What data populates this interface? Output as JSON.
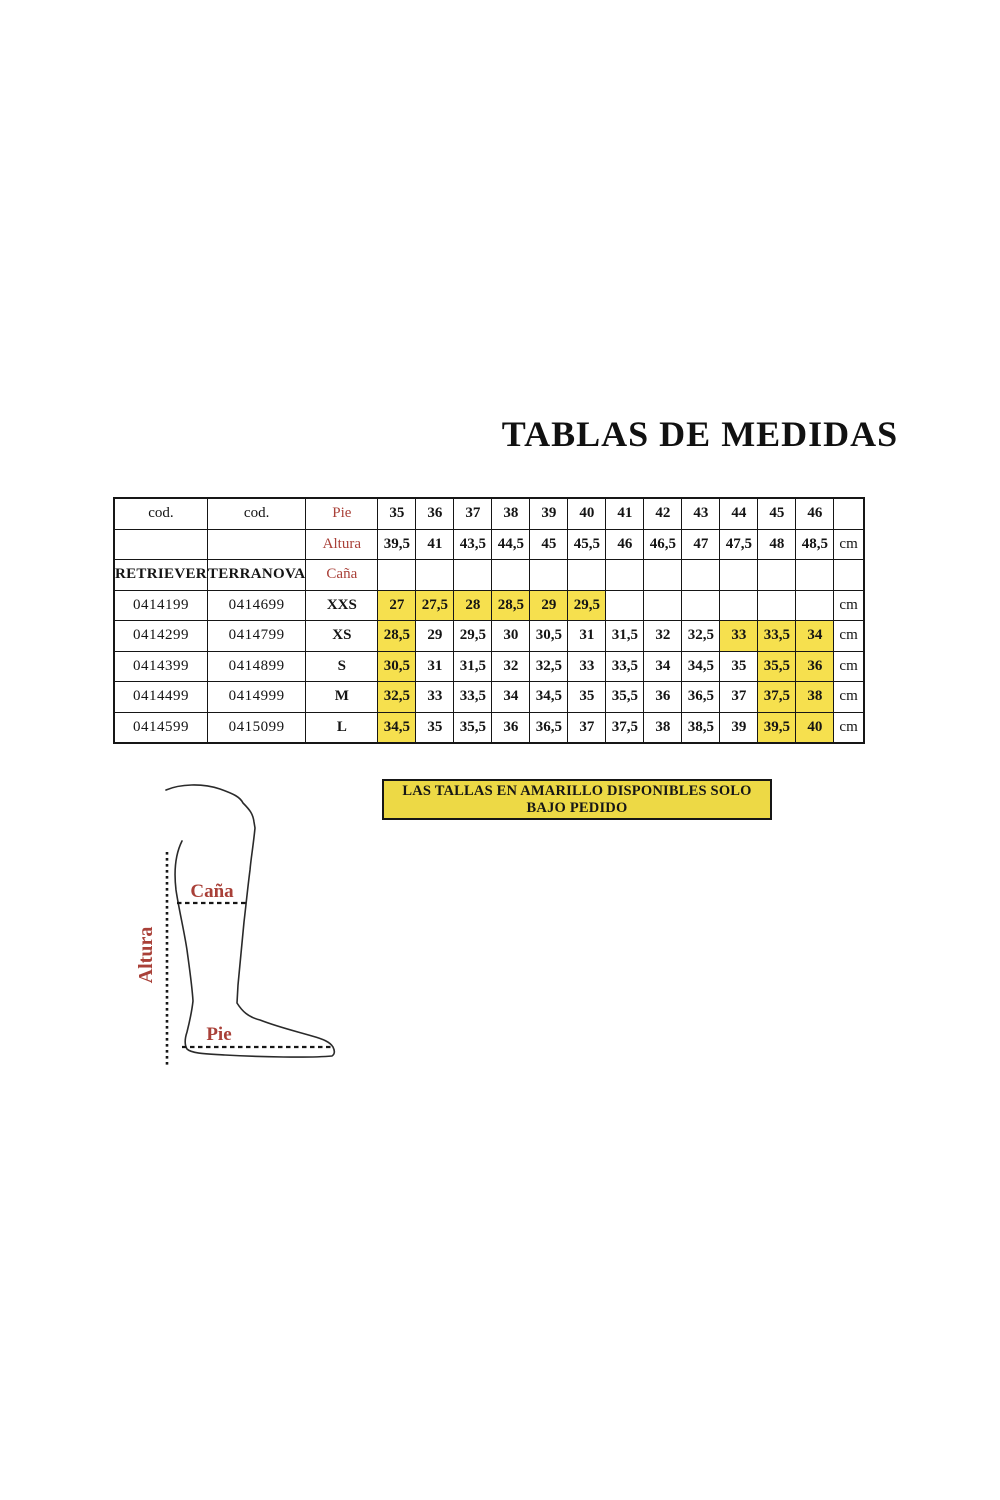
{
  "title": "TABLAS DE MEDIDAS",
  "colors": {
    "cell_highlight": "#F6E04E",
    "note_background": "#EDD945",
    "label_red": "#A94038"
  },
  "table": {
    "cod_header_1": "cod.",
    "cod_header_2": "cod.",
    "pie_label": "Pie",
    "altura_label": "Altura",
    "cana_label": "Caña",
    "brand_1": "RETRIEVER",
    "brand_2": "TERRANOVA",
    "unit": "cm",
    "pie_sizes": [
      "35",
      "36",
      "37",
      "38",
      "39",
      "40",
      "41",
      "42",
      "43",
      "44",
      "45",
      "46"
    ],
    "altura_values": [
      "39,5",
      "41",
      "43,5",
      "44,5",
      "45",
      "45,5",
      "46",
      "46,5",
      "47",
      "47,5",
      "48",
      "48,5"
    ],
    "size_rows": [
      {
        "cod1": "0414199",
        "cod2": "0414699",
        "size": "XXS",
        "unit": "cm",
        "values": [
          "27",
          "27,5",
          "28",
          "28,5",
          "29",
          "29,5",
          "",
          "",
          "",
          "",
          "",
          ""
        ],
        "highlight": [
          true,
          true,
          true,
          true,
          true,
          true,
          false,
          false,
          false,
          false,
          false,
          false
        ]
      },
      {
        "cod1": "0414299",
        "cod2": "0414799",
        "size": "XS",
        "unit": "cm",
        "values": [
          "28,5",
          "29",
          "29,5",
          "30",
          "30,5",
          "31",
          "31,5",
          "32",
          "32,5",
          "33",
          "33,5",
          "34"
        ],
        "highlight": [
          true,
          false,
          false,
          false,
          false,
          false,
          false,
          false,
          false,
          true,
          true,
          true
        ]
      },
      {
        "cod1": "0414399",
        "cod2": "0414899",
        "size": "S",
        "unit": "cm",
        "values": [
          "30,5",
          "31",
          "31,5",
          "32",
          "32,5",
          "33",
          "33,5",
          "34",
          "34,5",
          "35",
          "35,5",
          "36"
        ],
        "highlight": [
          true,
          false,
          false,
          false,
          false,
          false,
          false,
          false,
          false,
          false,
          true,
          true
        ]
      },
      {
        "cod1": "0414499",
        "cod2": "0414999",
        "size": "M",
        "unit": "cm",
        "values": [
          "32,5",
          "33",
          "33,5",
          "34",
          "34,5",
          "35",
          "35,5",
          "36",
          "36,5",
          "37",
          "37,5",
          "38"
        ],
        "highlight": [
          true,
          false,
          false,
          false,
          false,
          false,
          false,
          false,
          false,
          false,
          true,
          true
        ]
      },
      {
        "cod1": "0414599",
        "cod2": "0415099",
        "size": "L",
        "unit": "cm",
        "values": [
          "34,5",
          "35",
          "35,5",
          "36",
          "36,5",
          "37",
          "37,5",
          "38",
          "38,5",
          "39",
          "39,5",
          "40"
        ],
        "highlight": [
          true,
          false,
          false,
          false,
          false,
          false,
          false,
          false,
          false,
          false,
          true,
          true
        ]
      }
    ]
  },
  "note_text": "LAS TALLAS EN AMARILLO DISPONIBLES SOLO BAJO PEDIDO",
  "diagram": {
    "altura_label": "Altura",
    "cana_label": "Caña",
    "pie_label": "Pie"
  }
}
